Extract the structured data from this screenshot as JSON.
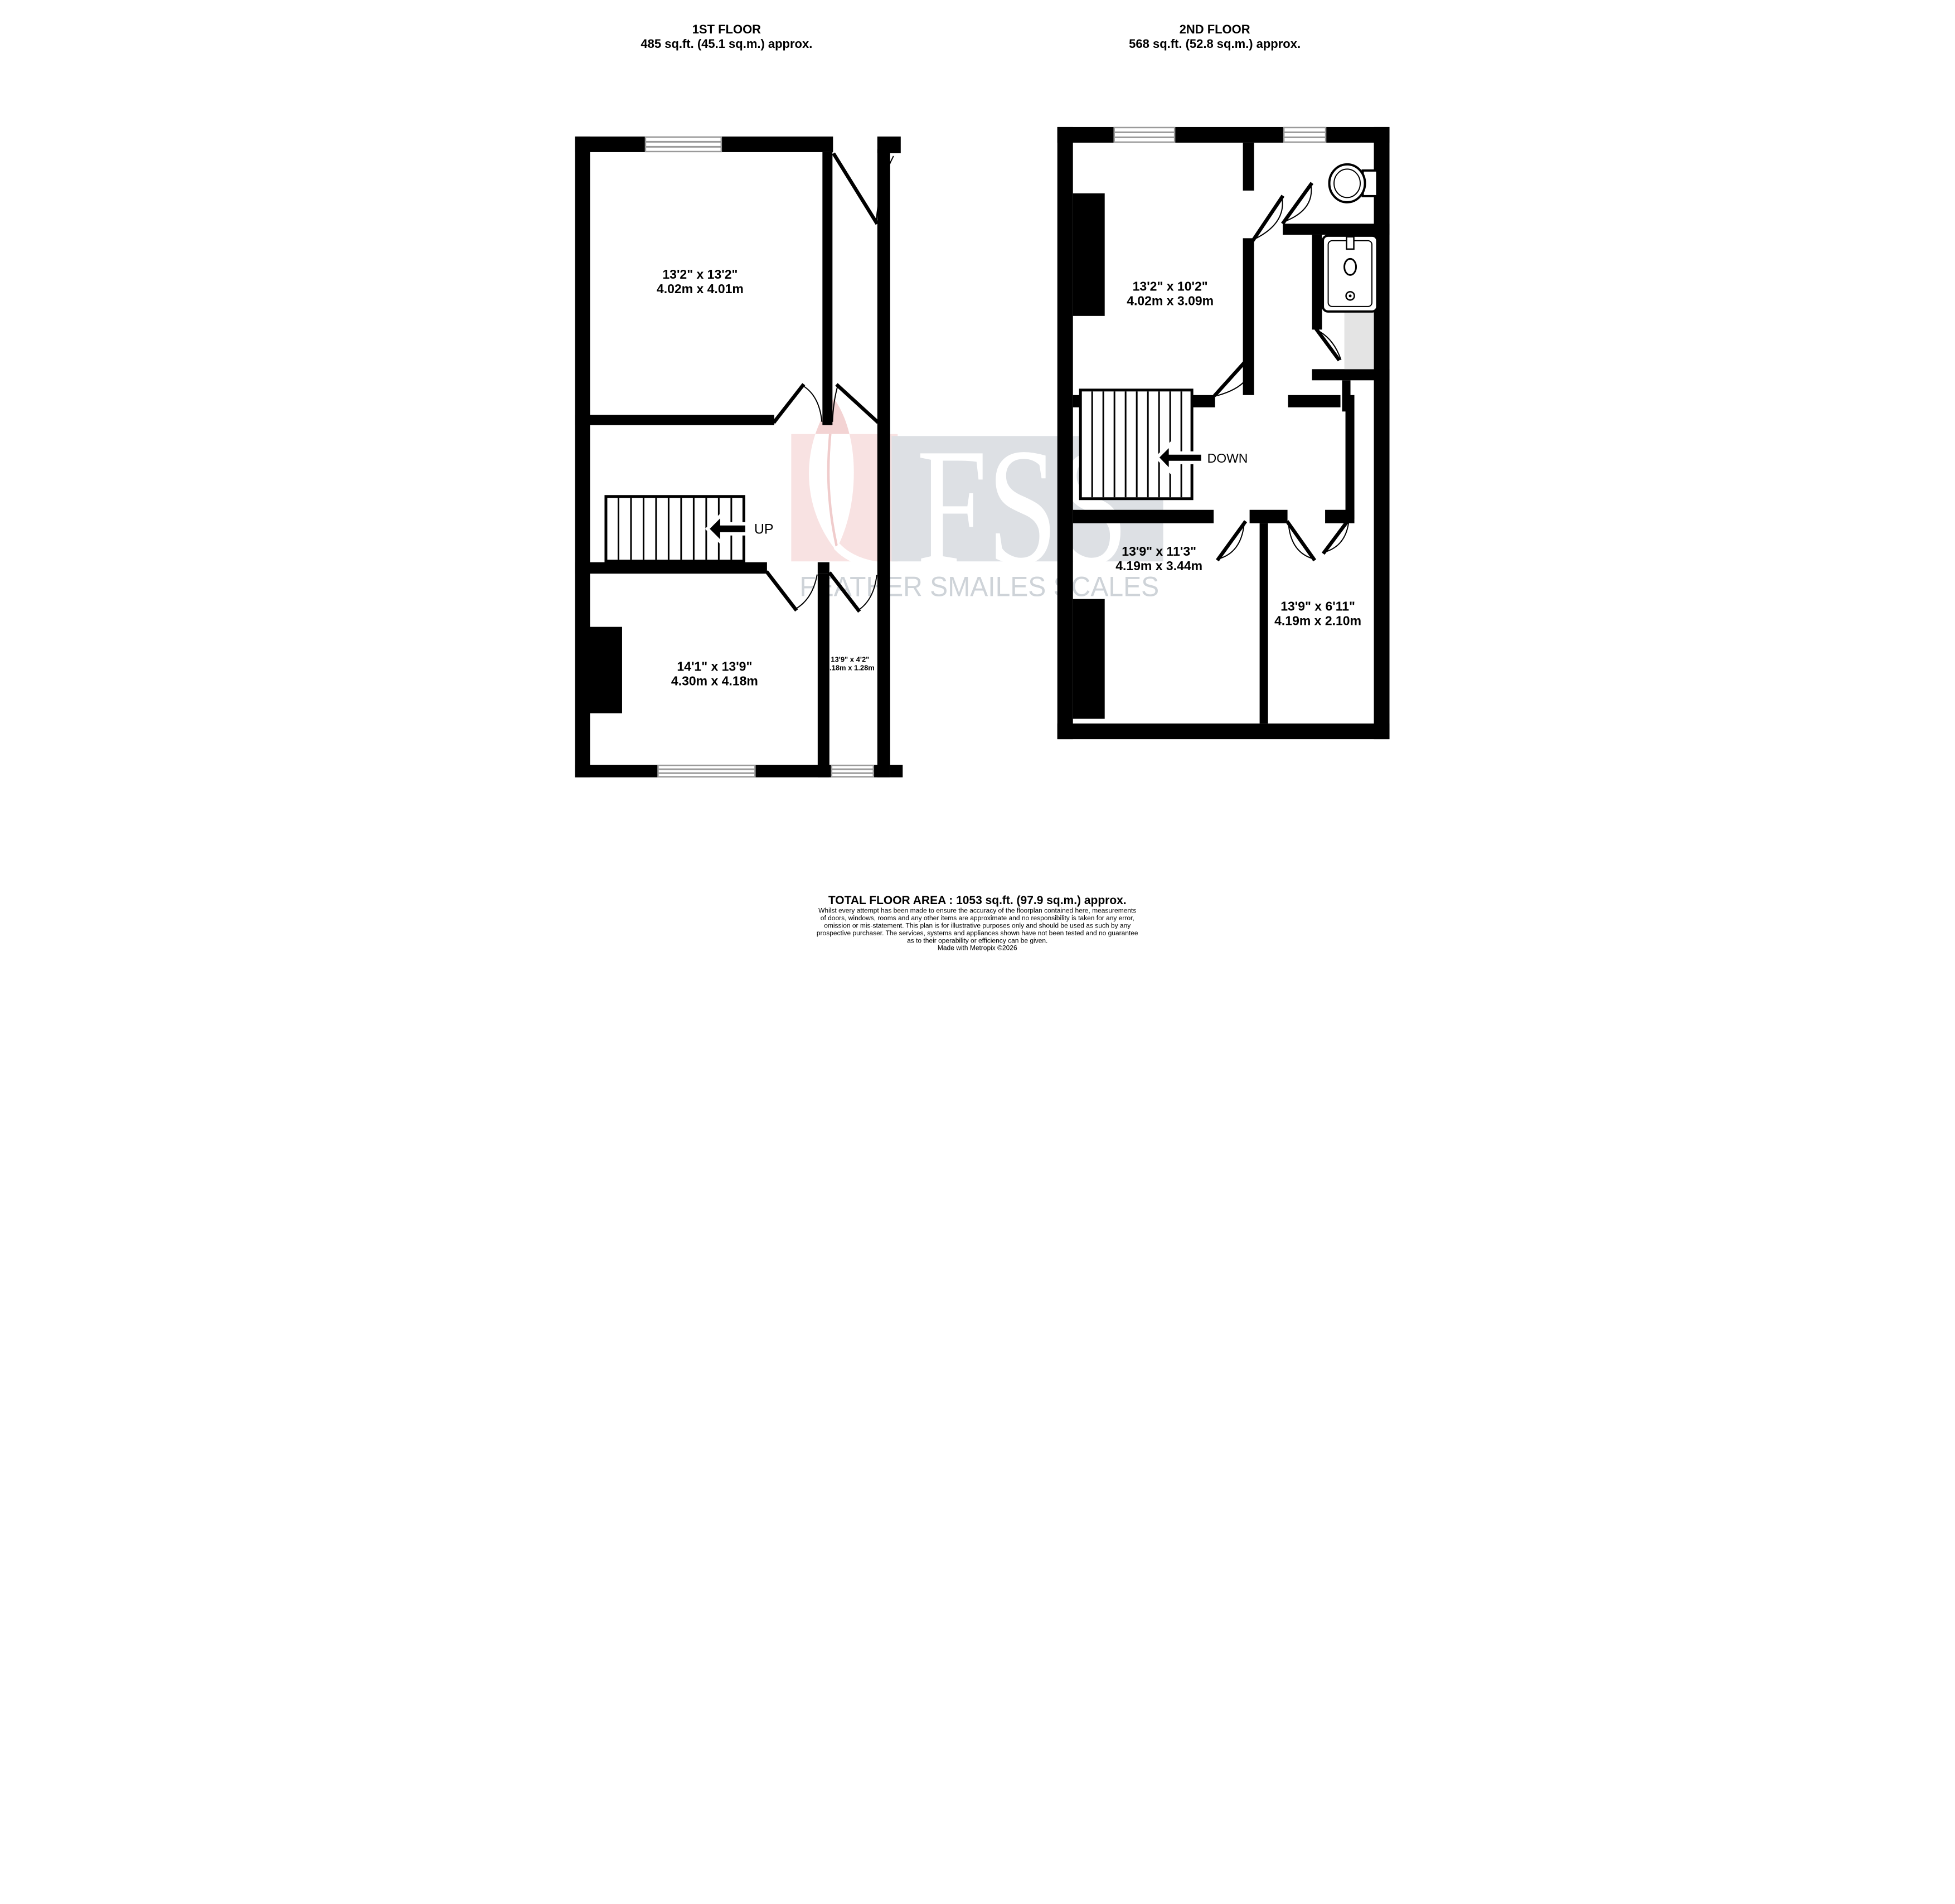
{
  "floors": [
    {
      "title": "1ST FLOOR",
      "area": "485 sq.ft. (45.1 sq.m.) approx.",
      "stair_label": "UP",
      "rooms": [
        {
          "imperial": "13'2\" x 13'2\"",
          "metric": "4.02m x 4.01m"
        },
        {
          "imperial": "14'1\" x 13'9\"",
          "metric": "4.30m x 4.18m"
        },
        {
          "imperial": "13'9\" x 4'2\"",
          "metric": "4.18m x 1.28m"
        }
      ]
    },
    {
      "title": "2ND FLOOR",
      "area": "568 sq.ft. (52.8 sq.m.) approx.",
      "stair_label": "DOWN",
      "rooms": [
        {
          "imperial": "13'2\" x 10'2\"",
          "metric": "4.02m x 3.09m"
        },
        {
          "imperial": "13'9\" x 11'3\"",
          "metric": "4.19m x 3.44m"
        },
        {
          "imperial": "13'9\" x 6'11\"",
          "metric": "4.19m x 2.10m"
        }
      ]
    }
  ],
  "watermark": {
    "initials": "FSS",
    "name": "FEATHER SMAILES SCALES",
    "colors": {
      "pink": "#f8e2e2",
      "feather_pink": "#f3d3d3",
      "gray": "#dde0e4",
      "text_gray": "#ced3d8"
    }
  },
  "footer": {
    "total": "TOTAL FLOOR AREA : 1053 sq.ft. (97.9 sq.m.) approx.",
    "disclaimer_lines": [
      "Whilst every attempt has been made to ensure the accuracy of the floorplan contained here, measurements",
      "of doors, windows, rooms and any other items are approximate and no responsibility is taken for any error,",
      "omission or mis-statement. This plan is for illustrative purposes only and should be used as such by any",
      "prospective purchaser. The services, systems and appliances shown have not been tested and no guarantee",
      "as to their operability or efficiency can be given."
    ],
    "credit": "Made with Metropix ©2026"
  }
}
